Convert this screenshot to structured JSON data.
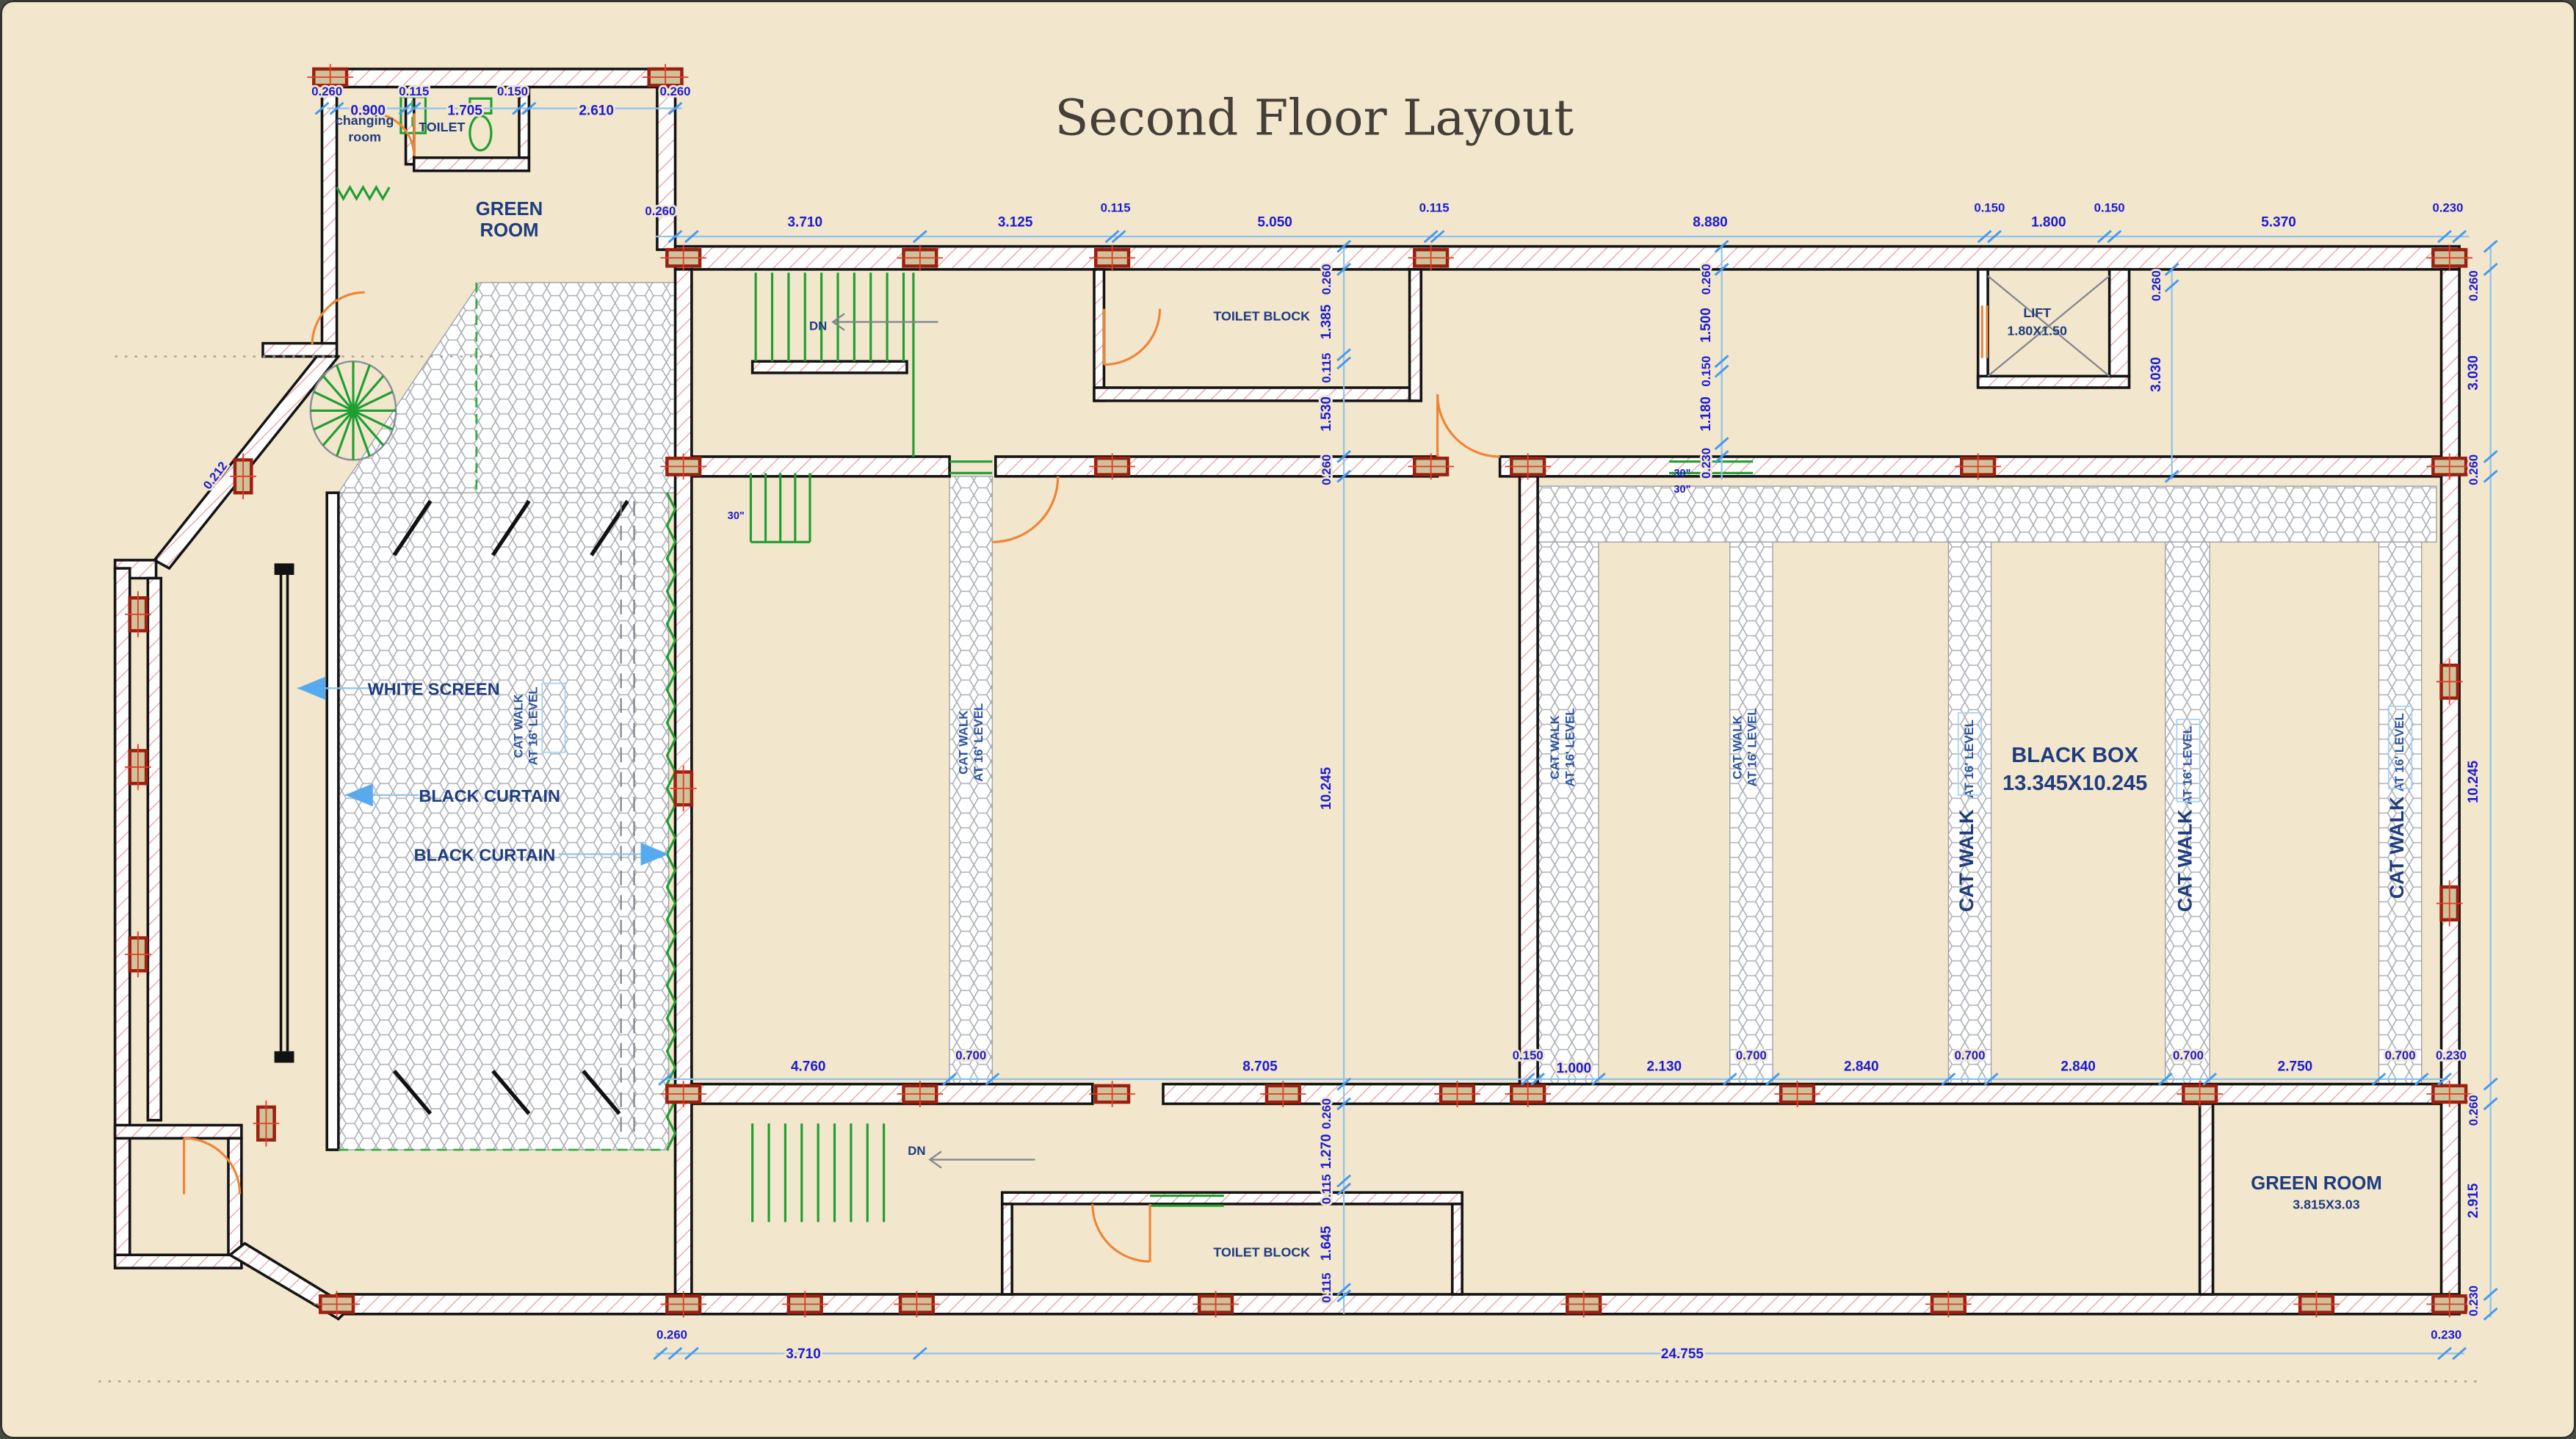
{
  "title": "Second Floor Layout",
  "colors": {
    "background": "#f2e6cd",
    "dimension_text": "#1b1bd1",
    "dimension_line": "#8fc3ec",
    "label_text": "#1e3c7e",
    "wall_hatch": "#e79b9b",
    "column_fill": "#cec29a",
    "column_border": "#9c1f10",
    "stairs_green": "#1f9e30",
    "door_orange": "#ef8434",
    "catwalk_hatch": "#9aa0a8"
  },
  "rooms": {
    "changing_room_line1": "changing",
    "changing_room_line2": "room",
    "toilet": "TOILET",
    "green_room_top_line1": "GREEN",
    "green_room_top_line2": "ROOM",
    "toilet_block_top": "TOILET BLOCK",
    "lift_name": "LIFT",
    "lift_size": "1.80X1.50",
    "black_box_name": "BLACK BOX",
    "black_box_size": "13.345X10.245",
    "toilet_block_bottom": "TOILET BLOCK",
    "green_room_bottom_name": "GREEN ROOM",
    "green_room_bottom_size": "3.815X3.03"
  },
  "stage": {
    "white_screen": "WHITE SCREEN",
    "black_curtain_1": "BLACK CURTAIN",
    "black_curtain_2": "BLACK CURTAIN"
  },
  "catwalk": {
    "line1": "CAT WALK",
    "line2": "AT 16' LEVEL"
  },
  "annotations": {
    "down": "DN",
    "riser30": "30\"",
    "wall_diag": "0.212"
  },
  "dims": {
    "green_top": [
      "0.260",
      "0.900",
      "0.115",
      "1.705",
      "0.150",
      "2.610",
      "0.260"
    ],
    "top": [
      "0.260",
      "3.710",
      "3.125",
      "0.115",
      "5.050",
      "0.115",
      "8.880",
      "0.150",
      "1.800",
      "0.150",
      "5.370",
      "0.230"
    ],
    "corridor_left_v": [
      "0.260",
      "1.385",
      "0.115",
      "1.530",
      "0.260"
    ],
    "corridor_mid_v": [
      "0.260",
      "1.500",
      "0.150",
      "1.180",
      "0.230"
    ],
    "lift_v": [
      "0.260",
      "3.030"
    ],
    "hall_height": "10.245",
    "right_v": [
      "0.260",
      "3.030",
      "0.260",
      "10.245",
      "0.260",
      "2.915",
      "0.230"
    ],
    "bottom_corridor_v": [
      "0.260",
      "1.270",
      "0.115",
      "1.645",
      "0.115"
    ],
    "bottom_inner": [
      "4.760",
      "0.700",
      "8.705",
      "0.150",
      "1.000",
      "2.130",
      "0.700",
      "2.840",
      "0.700",
      "2.840",
      "0.700",
      "2.750",
      "0.700",
      "0.230"
    ],
    "bottom_outer": [
      "0.260",
      "3.710",
      "24.755",
      "0.230"
    ]
  }
}
